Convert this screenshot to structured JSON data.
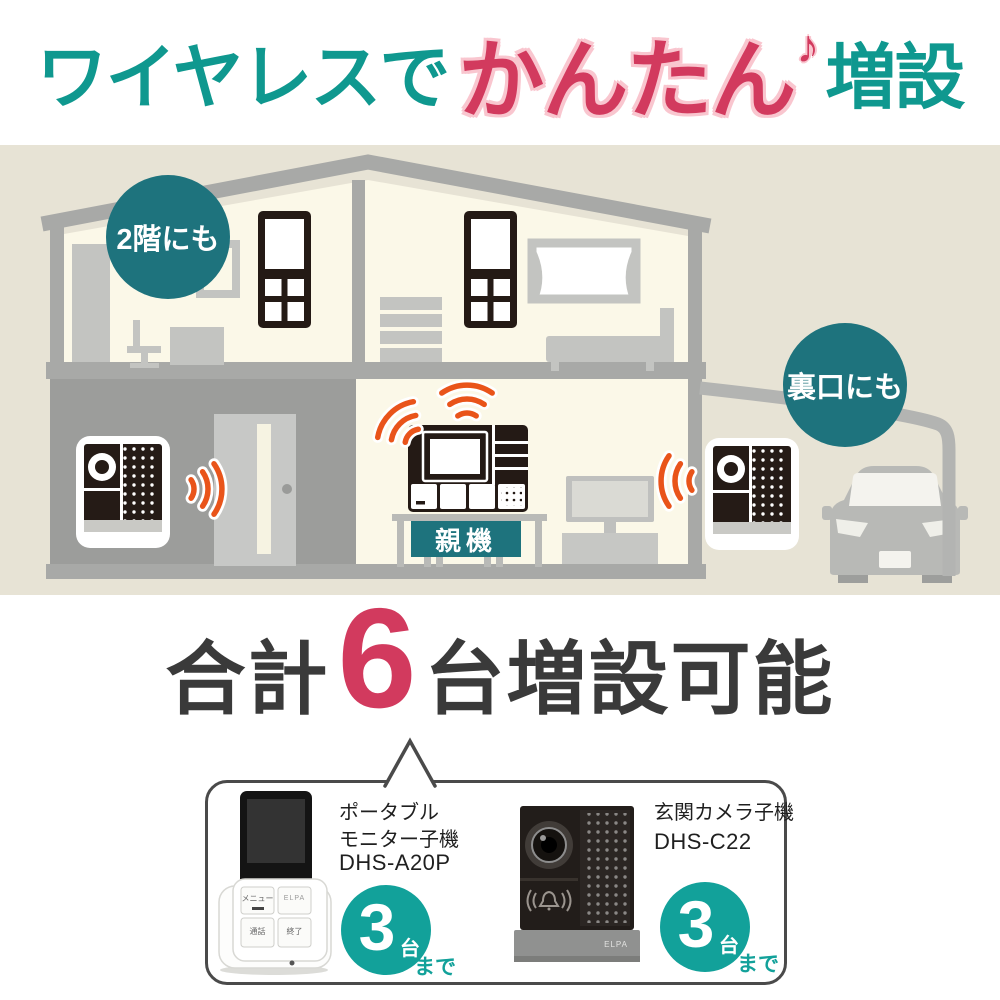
{
  "page": {
    "title": {
      "part1": "ワイヤレスで",
      "part2": "かんたん",
      "note": "♪",
      "part3": "増設"
    },
    "scene": {
      "second_floor_label": "2階にも",
      "back_door_label": "裏口にも",
      "main_unit_label": "親機"
    },
    "headline": {
      "prefix": "合計",
      "count": "6",
      "suffix": "台増設可能"
    },
    "products": {
      "monitor": {
        "name_line1": "ポータブル",
        "name_line2": "モニター子機",
        "model": "DHS-A20P",
        "max_count": "3",
        "unit": "台",
        "suffix": "まで",
        "buttons": {
          "menu": "メニュー",
          "brand": "ELPA",
          "talk": "通話",
          "end": "終了"
        }
      },
      "camera": {
        "name": "玄関カメラ子機",
        "model": "DHS-C22",
        "max_count": "3",
        "unit": "台",
        "suffix": "まで",
        "brand": "ELPA"
      }
    },
    "colors": {
      "teal-title": "#0f988f",
      "teal-dark": "#1e737d",
      "teal-badge": "#12a19a",
      "accent-red": "#d23a5e",
      "accent-pink": "#f9c6cf",
      "wave-orange": "#e9541a",
      "beige": "#e7e3d5",
      "ink": "#3a3a3a"
    }
  }
}
